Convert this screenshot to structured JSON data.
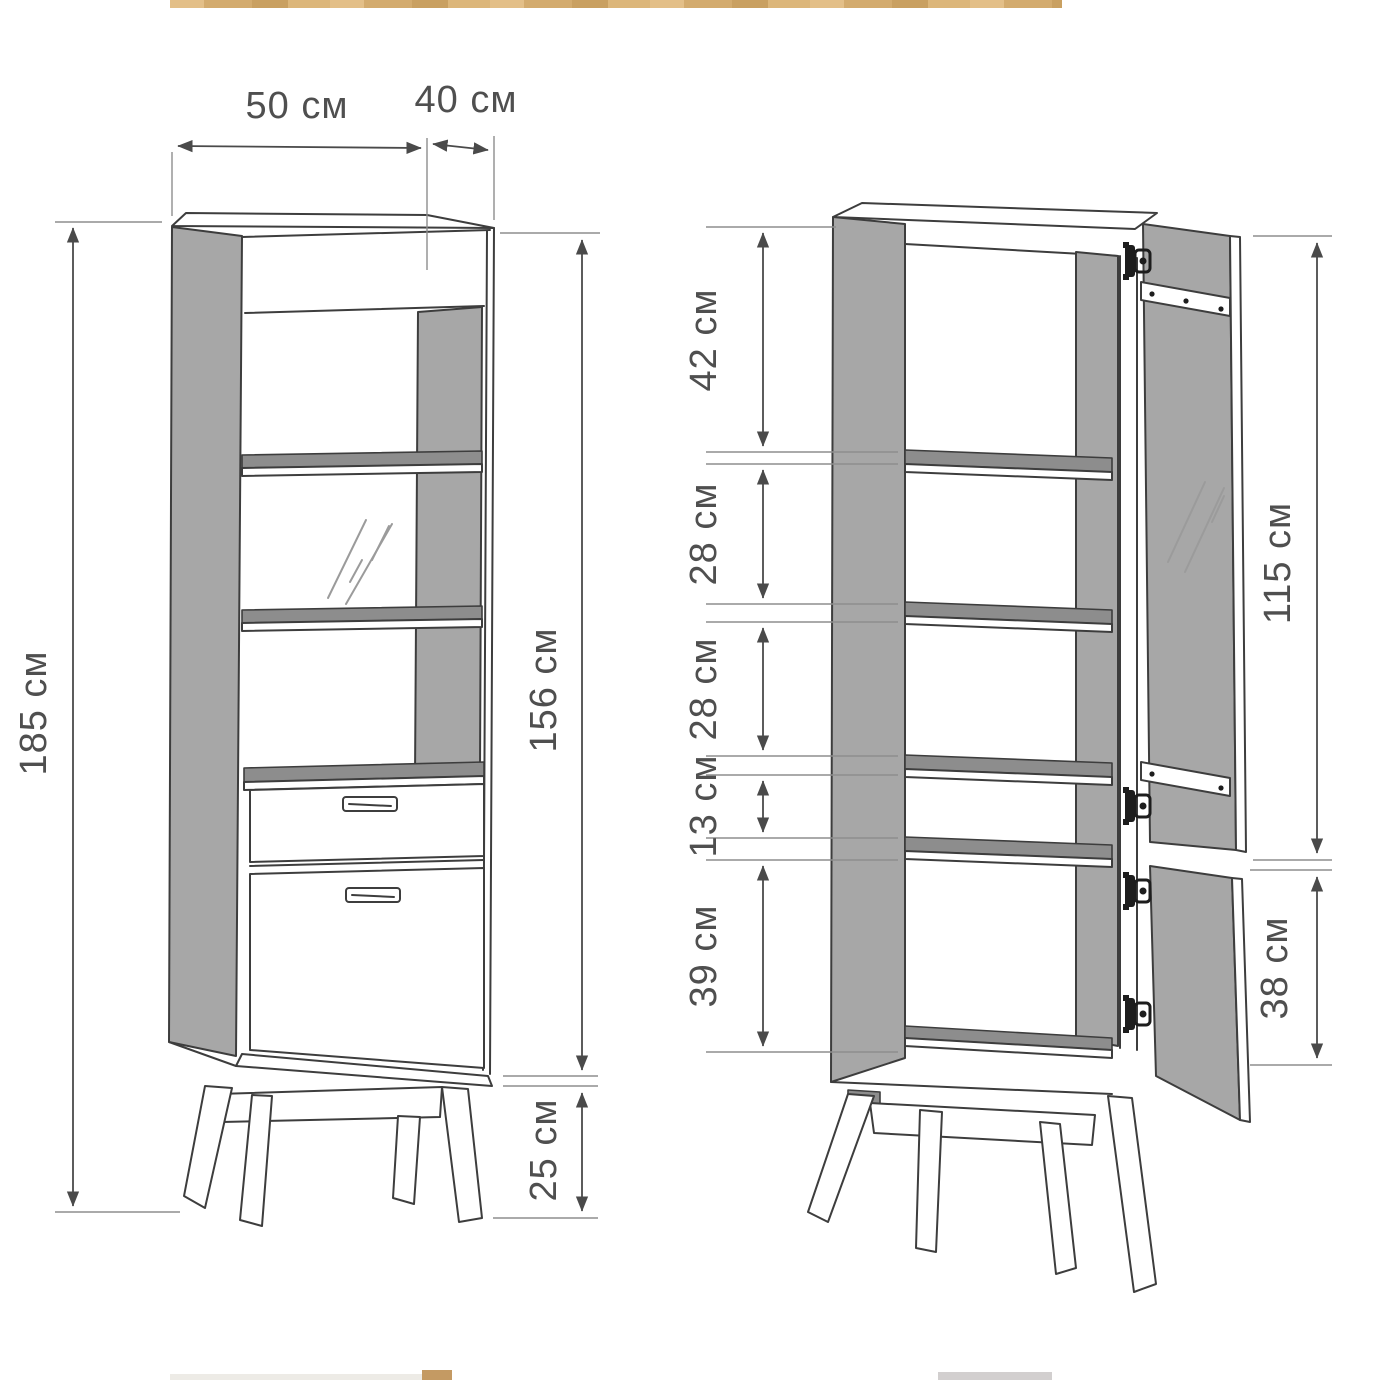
{
  "diagram": {
    "front_view": {
      "width": "50 см",
      "depth": "40 см",
      "total_height": "185 см",
      "body_height": "156 см",
      "legs": "25 см"
    },
    "open_view": {
      "sections": [
        "42 см",
        "28 см",
        "28 см",
        "13 см",
        "39 см"
      ],
      "glass_door": "115 см",
      "bottom_door": "38 см"
    }
  },
  "colors": {
    "outline": "#3d3d3d",
    "dimension": "#4a4a4a",
    "panel_gray": "#a7a7a7",
    "shelf_gray": "#8d8d8d",
    "label_text": "#4f4f4f",
    "wood_strip": "#d5ad72"
  }
}
